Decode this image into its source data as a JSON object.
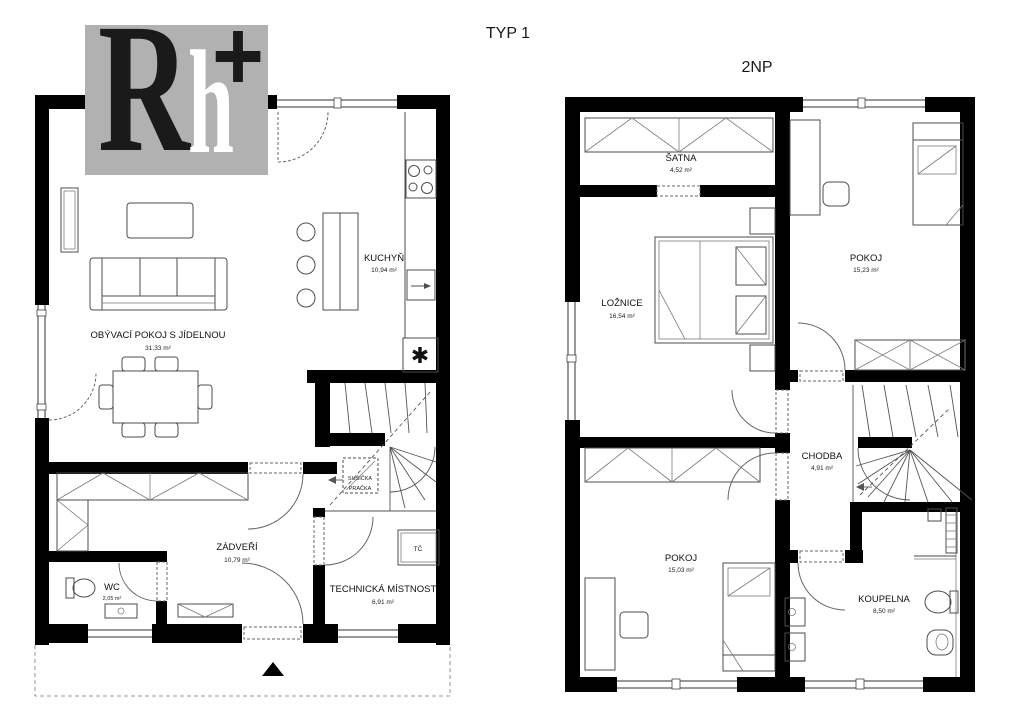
{
  "palette": {
    "wall_black": "#000000",
    "logo_gray": "#b1b1b1",
    "furniture_line": "#4d4d4d",
    "text": "#1a1a1a"
  },
  "titles": {
    "plan_left": "TYP 1",
    "plan_right": "2NP"
  },
  "logo": {
    "letter_r": "R",
    "letter_h": "h",
    "letter_plus": "+"
  },
  "floor1": {
    "living_room": {
      "name": "OBÝVACÍ POKOJ S JÍDELNOU",
      "area": "31,33 m²"
    },
    "kitchen": {
      "name": "KUCHYŇ",
      "area": "10,94 m²"
    },
    "entry_hall": {
      "name": "ZÁDVEŘÍ",
      "area": "10,79 m²"
    },
    "wc": {
      "name": "WC",
      "area": "2,05 m²"
    },
    "technical_room": {
      "name": "TECHNICKÁ MÍSTNOST",
      "area": "6,91 m²"
    },
    "dryer_label": "SUŠIČKA",
    "washer_label": "PRAČKA",
    "heat_pump_label": "TČ",
    "fireplace_symbol": "✱"
  },
  "floor2": {
    "wardrobe_room": {
      "name": "ŠATNA",
      "area": "4,52 m²"
    },
    "bedroom": {
      "name": "LOŽNICE",
      "area": "16,54 m²"
    },
    "room_upper": {
      "name": "POKOJ",
      "area": "15,23 m²"
    },
    "hallway": {
      "name": "CHODBA",
      "area": "4,91 m²"
    },
    "room_lower": {
      "name": "POKOJ",
      "area": "15,03 m²"
    },
    "bathroom": {
      "name": "KOUPELNA",
      "area": "8,50 m²"
    }
  }
}
